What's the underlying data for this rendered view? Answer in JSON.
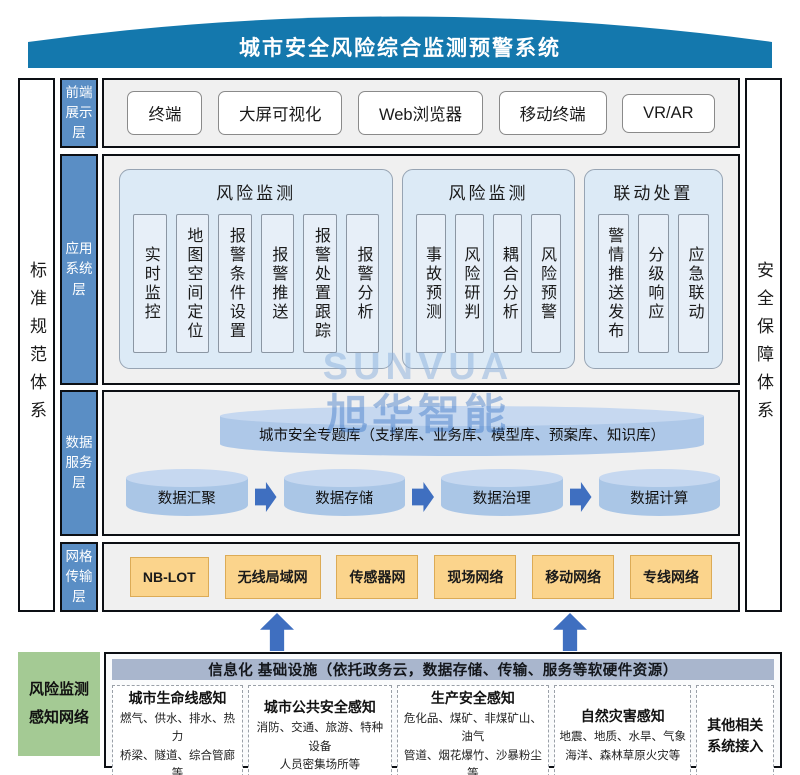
{
  "banner": {
    "title": "城市安全风险综合监测预警系统",
    "color": "#1478ad"
  },
  "side_bars": {
    "left": "标准规范体系",
    "right": "安全保障体系"
  },
  "layer_labels": {
    "frontend": "前端\n展示\n层",
    "application": "应用\n系统\n层",
    "data": "数据\n服务\n层",
    "network": "网格\n传输\n层"
  },
  "frontend_layer": {
    "items": [
      "终端",
      "大屏可视化",
      "Web浏览器",
      "移动终端",
      "VR/AR"
    ]
  },
  "application_layer": {
    "groups": [
      {
        "title": "风险监测",
        "items": [
          "实时监控",
          "地图空间定位",
          "报警条件设置",
          "报警推送",
          "报警处置跟踪",
          "报警分析"
        ]
      },
      {
        "title": "风险监测",
        "items": [
          "事故预测",
          "风险研判",
          "耦合分析",
          "风险预警"
        ]
      },
      {
        "title": "联动处置",
        "items": [
          "警情推送发布",
          "分级响应",
          "应急联动"
        ]
      }
    ]
  },
  "data_layer": {
    "database": "城市安全专题库（支撑库、业务库、模型库、预案库、知识库）",
    "flow": [
      "数据汇聚",
      "数据存储",
      "数据治理",
      "数据计算"
    ]
  },
  "network_layer": {
    "items": [
      "NB-LOT",
      "无线局域网",
      "传感器网",
      "现场网络",
      "移动网络",
      "专线网络"
    ]
  },
  "infrastructure": {
    "side_label": "风险监测\n感知网络",
    "header": "信息化 基础设施（依托政务云，数据存储、传输、服务等软硬件资源）",
    "boxes": [
      {
        "title": "城市生命线感知",
        "desc": "燃气、供水、排水、热力\n桥梁、隧道、综合管廊等"
      },
      {
        "title": "城市公共安全感知",
        "desc": "消防、交通、旅游、特种设备\n人员密集场所等"
      },
      {
        "title": "生产安全感知",
        "desc": "危化品、煤矿、非煤矿山、油气\n管道、烟花爆竹、沙暴粉尘等"
      },
      {
        "title": "自然灾害感知",
        "desc": "地震、地质、水旱、气象\n海洋、森林草原火灾等"
      },
      {
        "title": "其他相关\n系统接入",
        "desc": ""
      }
    ]
  },
  "watermark": {
    "line1": "SUNVUA",
    "line2": "旭华智能"
  },
  "colors": {
    "banner": "#1478ad",
    "layer_label": "#5a8ec5",
    "row_bg": "#f0f0f0",
    "group_bg": "#dceaf6",
    "cylinder_body": "#aac6e6",
    "cylinder_top": "#c6d8f0",
    "arrow": "#3f6fc0",
    "network_box": "#fbd48c",
    "green_box": "#a4ca94",
    "infra_header": "#a9b6cd"
  }
}
